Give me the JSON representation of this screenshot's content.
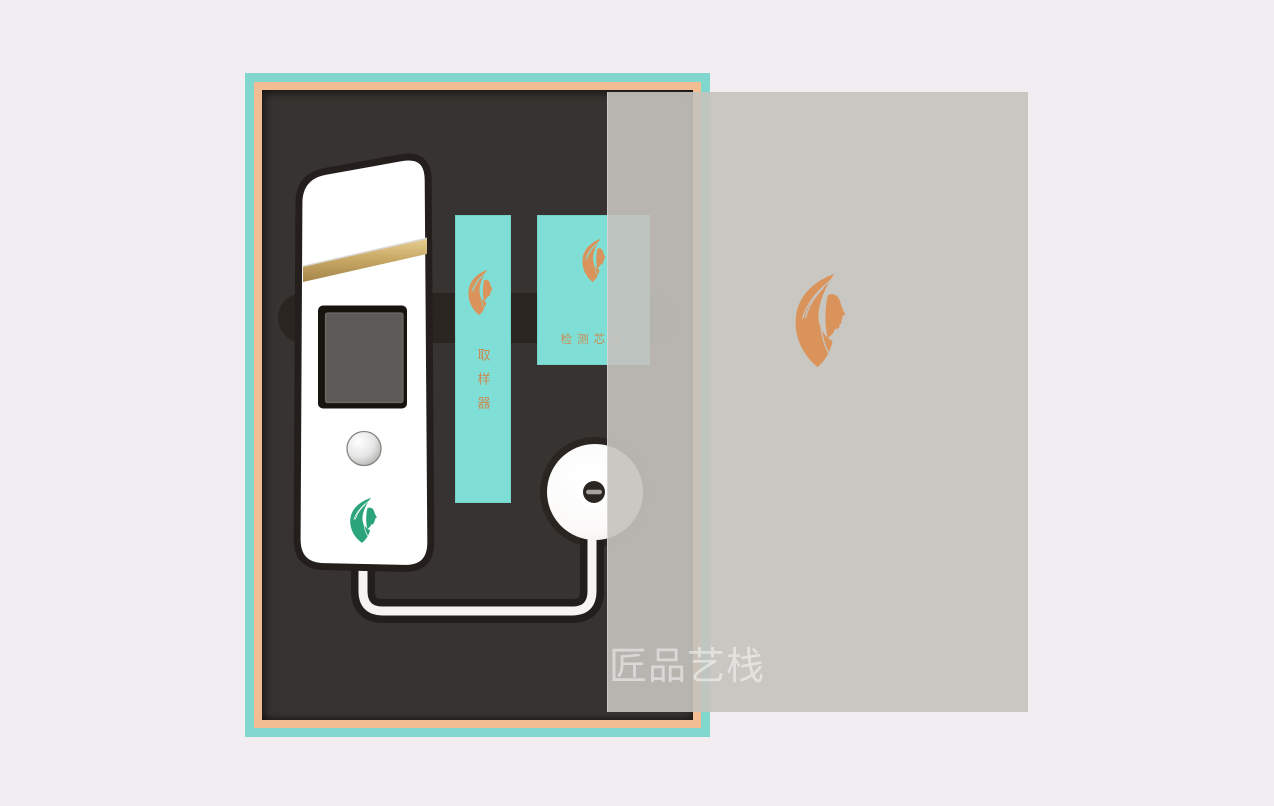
{
  "scene": {
    "description": "beauty-device packaging box with translucent lid",
    "width": 1274,
    "height": 806
  },
  "watermark": {
    "text": "匠品艺栈"
  },
  "cards": [
    {
      "name": "sampler-card",
      "label": "取样器",
      "orientation": "vertical",
      "background": "#7fdfd6",
      "label_color": "#cc8950",
      "logo": "face-leaf-logo-icon",
      "logo_color": "#d9935b"
    },
    {
      "name": "chip-card",
      "label": "检测芯片",
      "orientation": "horizontal",
      "background": "#7fdfd6",
      "label_color": "#cc8950",
      "logo": "face-leaf-logo-icon",
      "logo_color": "#d9935b"
    }
  ],
  "device": {
    "name": "handheld-skin-tester",
    "body_color": "#ffffff",
    "outline_color": "#241f1d",
    "gold_band_color": "#c9aa66",
    "screen_color": "#5e5a57",
    "button_style": "silver-round",
    "logo": "face-leaf-logo-icon",
    "logo_color": "#2ba47c"
  },
  "disc": {
    "name": "sensor-disc",
    "color": "#fcfbfa",
    "hub_color": "#2b2622"
  },
  "cable": {
    "color": "#f5f4f2"
  },
  "lid": {
    "logo": "face-leaf-logo-icon",
    "logo_color": "#d9935b"
  },
  "colors": {
    "bg": "#f1edf0",
    "box_teal": "#81d7ce",
    "box_orange": "#f2bd93",
    "foam": "#373330",
    "slot": "#2a2521",
    "card_teal": "#7fdfd6",
    "card_text": "#cc8950",
    "logo_orange": "#d9935b",
    "logo_green": "#2ba47c",
    "device_outline": "#241f1d",
    "device_body": "#ffffff",
    "screen": "#5e5a57",
    "cable": "#f5f4f2",
    "cable_channel": "#221e1b",
    "disc": "#fcfbfa",
    "hub": "#2b2622",
    "lid": "rgba(197,195,189,0.91)",
    "watermark_color": "rgba(255,255,255,0.48)"
  }
}
